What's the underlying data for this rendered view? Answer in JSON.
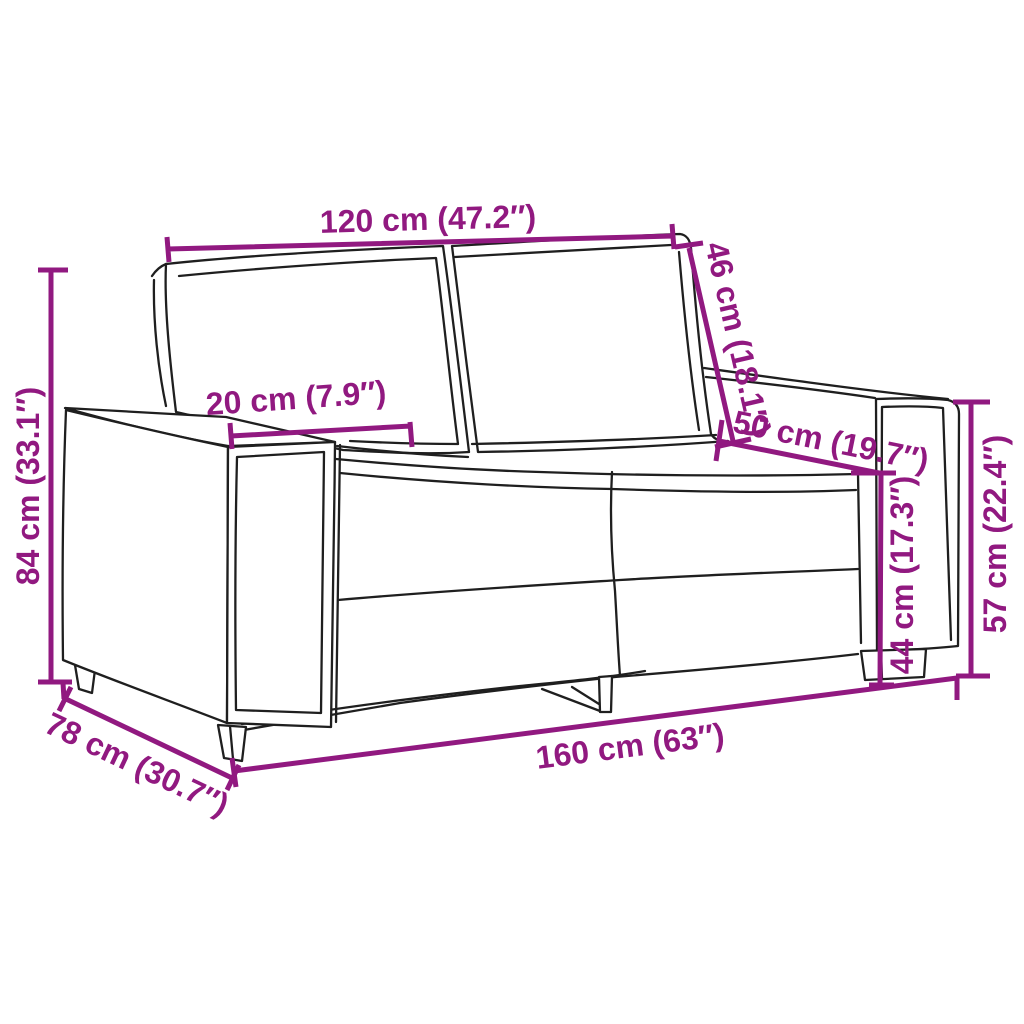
{
  "colors": {
    "accent": "#911980",
    "line": "#1f1f1f",
    "background": "#ffffff"
  },
  "figure": {
    "name": "two-seater-sofa-outline-drawing"
  },
  "dims": {
    "width_seat": {
      "label": "120 cm (47.2″)"
    },
    "height_back": {
      "label": "46 cm (18.1″)"
    },
    "height_total": {
      "label": "84 cm (33.1″)"
    },
    "width_arm": {
      "label": "20 cm (7.9″)"
    },
    "depth_seat": {
      "label": "50 cm (19.7″)"
    },
    "height_seat": {
      "label": "44 cm (17.3″)"
    },
    "height_arm": {
      "label": "57 cm (22.4″)"
    },
    "width_total": {
      "label": "160 cm (63″)"
    },
    "depth_total": {
      "label": "78 cm (30.7″)"
    }
  }
}
